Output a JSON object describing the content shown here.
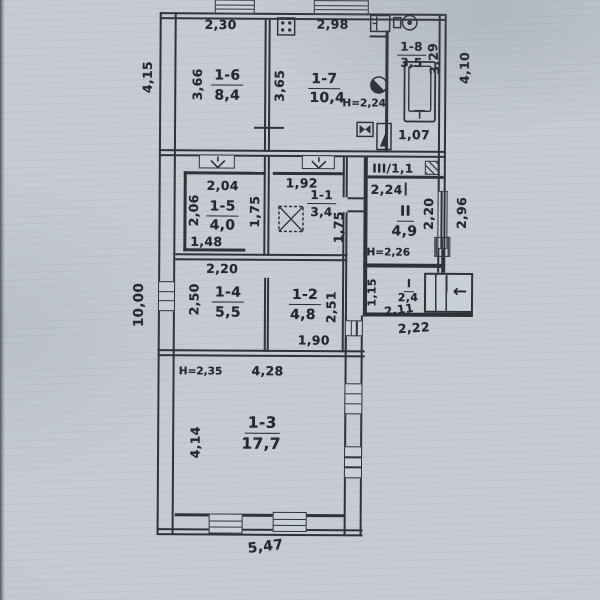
{
  "colors": {
    "paper": "#c7ccd3",
    "ink": "#303238"
  },
  "icons": {
    "entrance_arrow": "←"
  },
  "floorplan": {
    "exterior_dims": {
      "left_upper": "4,15",
      "left_lower": "10,00",
      "right_upper": "4,10",
      "right_mid": "2,96",
      "bottom": "5,47"
    },
    "rooms": {
      "r1_6": {
        "number": "1-6",
        "area": "8,4",
        "w": "2,30",
        "d": "3,66"
      },
      "r1_7": {
        "number": "1-7",
        "area": "10,4",
        "w": "2,98",
        "d": "3,65",
        "h": "H=2,24"
      },
      "r1_8": {
        "number": "1-8",
        "area": "3,5",
        "d": "3,29",
        "w": "1,07"
      },
      "r1_5": {
        "number": "1-5",
        "area": "4,0",
        "w": "2,04",
        "d": "2,06",
        "d2": "1,75",
        "w2": "1,48"
      },
      "r1_1": {
        "number": "1-1",
        "area": "3,4",
        "w": "1,92",
        "d": "1,75"
      },
      "r2": {
        "number": "II",
        "area": "4,9",
        "w": "2,24",
        "d": "2,20",
        "h": "H=2,26"
      },
      "r3": {
        "number": "III/1,1"
      },
      "r1_4": {
        "number": "1-4",
        "area": "5,5",
        "w": "2,20",
        "d": "2,50"
      },
      "r1_2": {
        "number": "1-2",
        "area": "4,8",
        "d": "2,51",
        "w": "1,90"
      },
      "r1": {
        "number": "I",
        "area": "2,4",
        "w": "2,11",
        "w2": "2,22",
        "d": "1,15"
      },
      "r1_3": {
        "number": "1-3",
        "area": "17,7",
        "w": "4,28",
        "d": "4,14",
        "h": "H=2,35"
      }
    }
  }
}
